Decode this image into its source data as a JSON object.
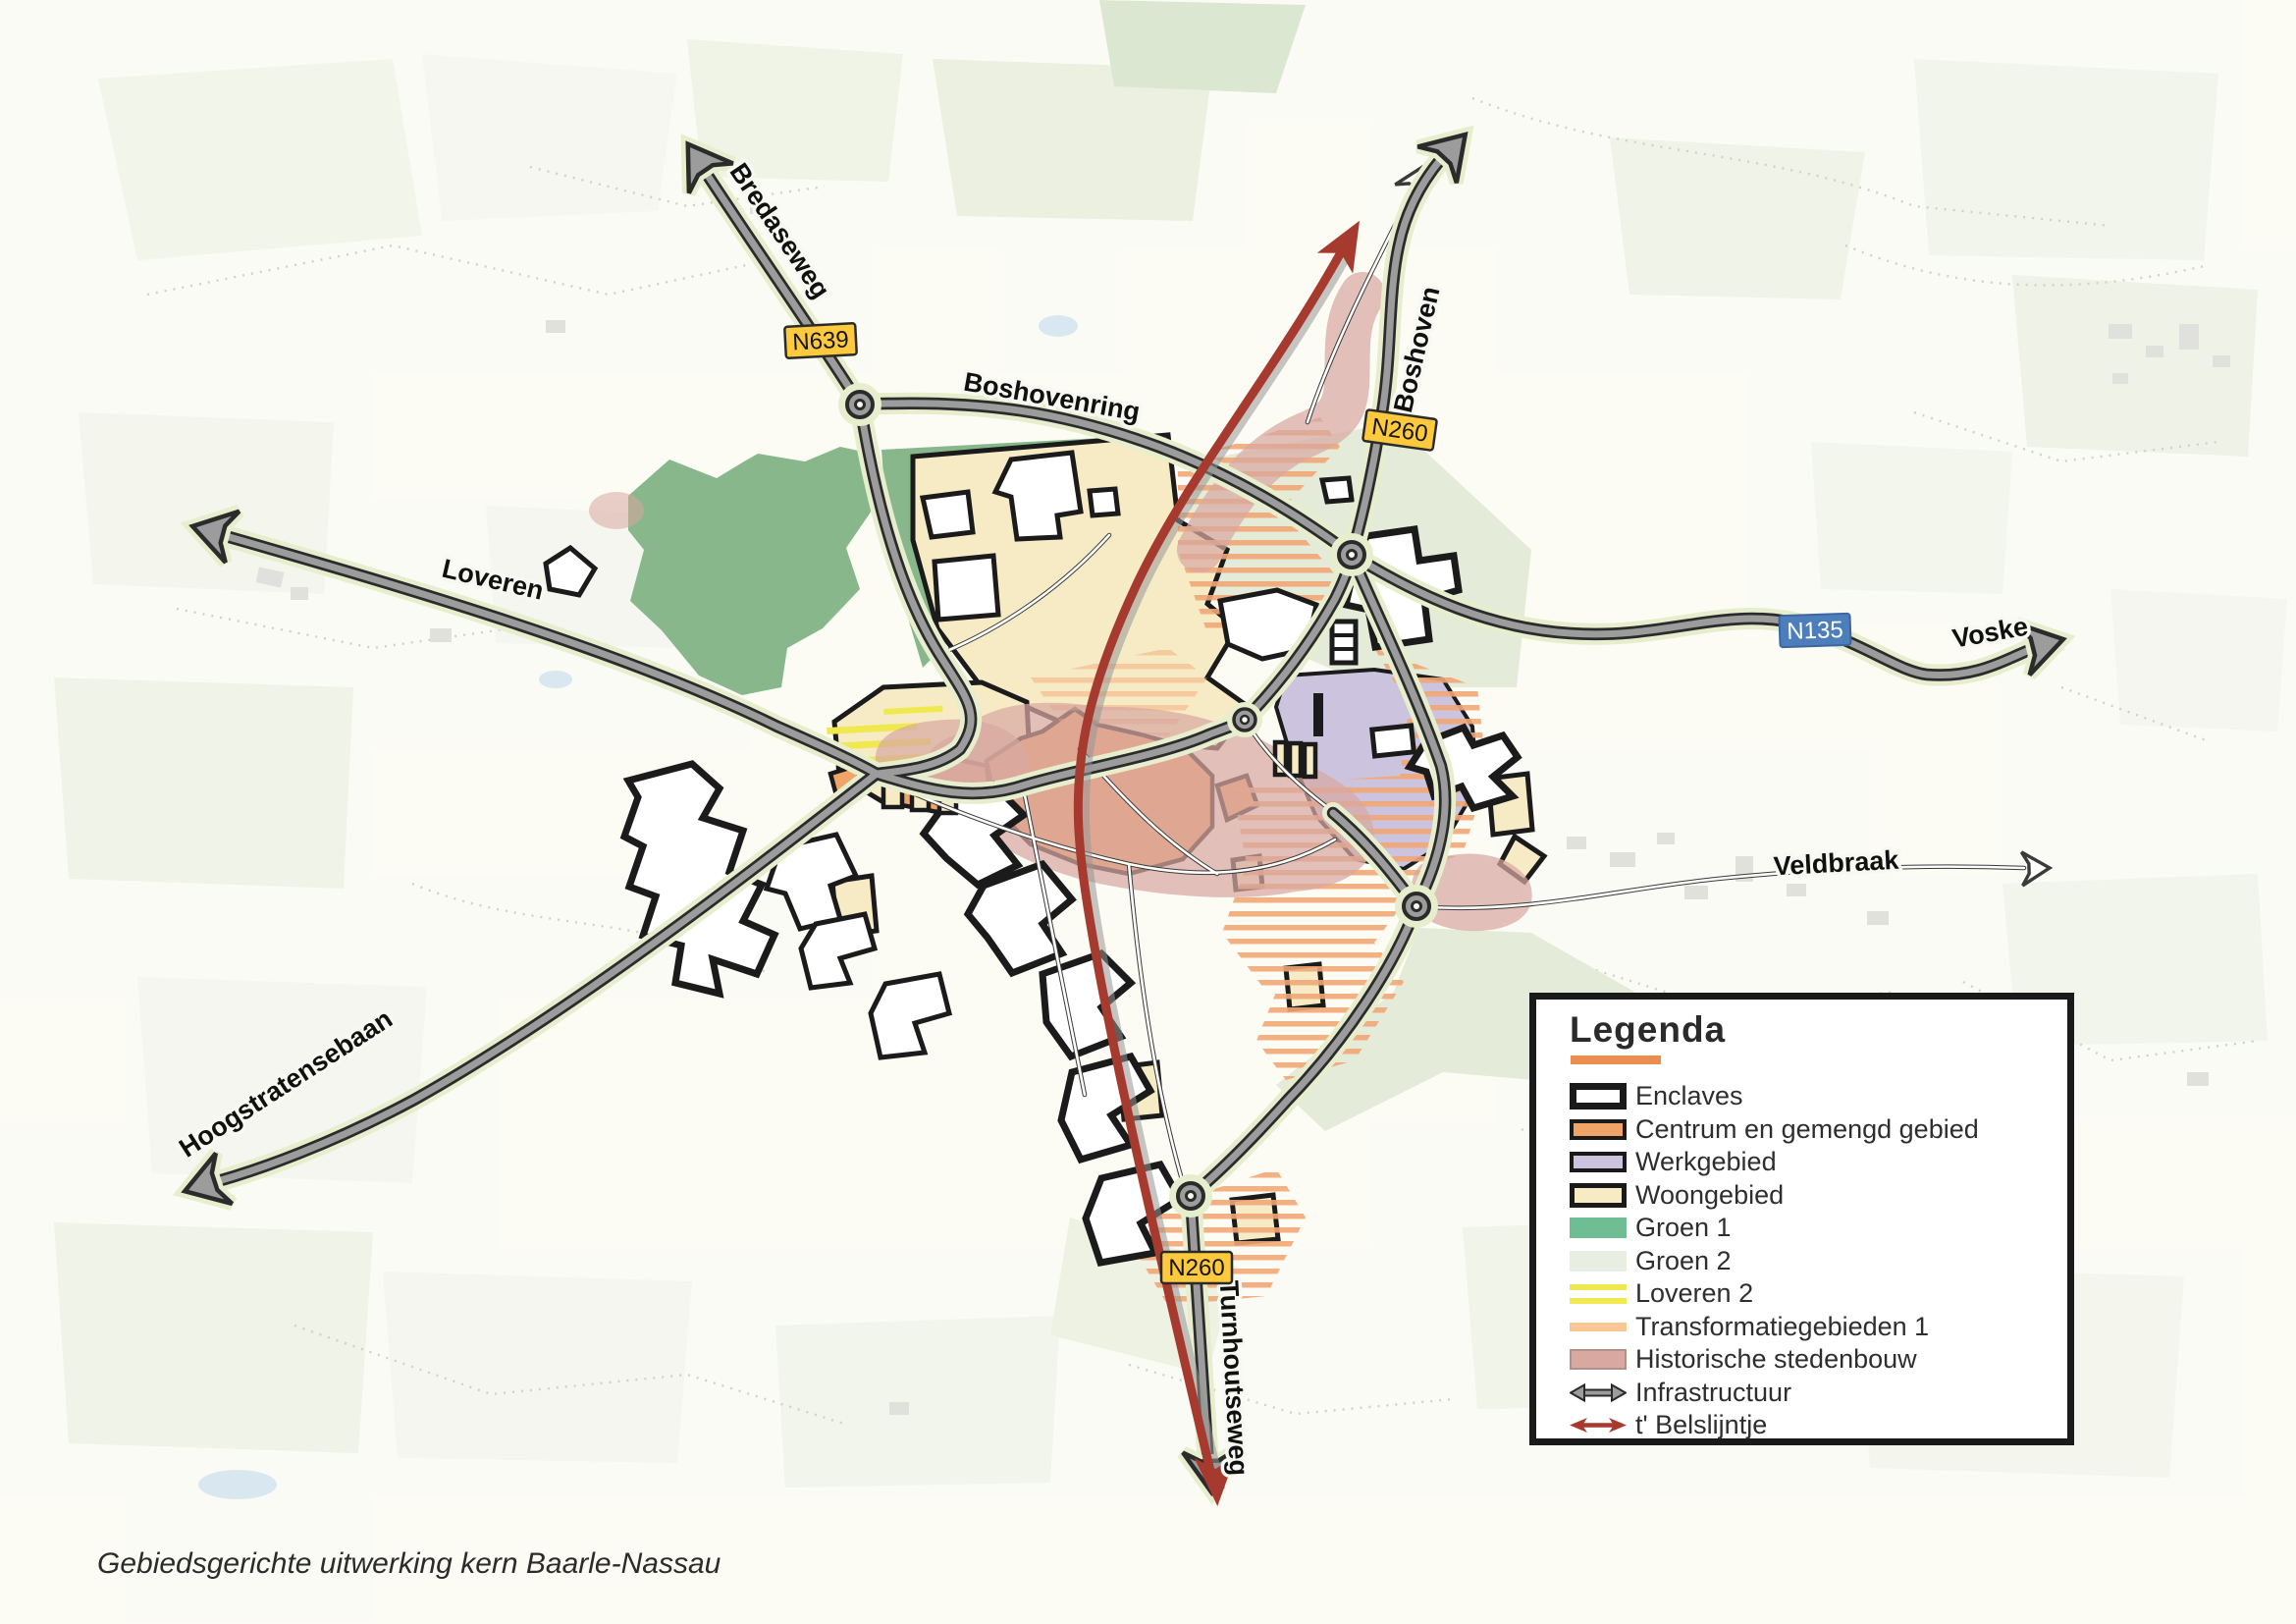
{
  "caption": "Gebiedsgerichte uitwerking kern Baarle-Nassau",
  "map": {
    "road_labels": {
      "bredaseweg": "Bredaseweg",
      "boshovenring": "Boshovenring",
      "boshoven": "Boshoven",
      "loveren": "Loveren",
      "voske": "Voske",
      "veldbraak": "Veldbraak",
      "hoogstratensebaan": "Hoogstratensebaan",
      "turnhoutseweg": "Turnhoutseweg"
    },
    "badges": {
      "n639": "N639",
      "n260_north": "N260",
      "n260_south": "N260",
      "n135": "N135"
    }
  },
  "legend": {
    "title": "Legenda",
    "items": [
      {
        "label": "Enclaves"
      },
      {
        "label": "Centrum en gemengd gebied"
      },
      {
        "label": "Werkgebied"
      },
      {
        "label": "Woongebied"
      },
      {
        "label": "Groen 1"
      },
      {
        "label": "Groen 2"
      },
      {
        "label": "Loveren 2"
      },
      {
        "label": "Transformatiegebieden 1"
      },
      {
        "label": "Historische stedenbouw"
      },
      {
        "label": "Infrastructuur"
      },
      {
        "label": "t' Belslijntje"
      }
    ]
  },
  "colors": {
    "centrum": "#F0A468",
    "werkgebied": "#CCC4DE",
    "woongebied": "#F6EBC5",
    "groen1": "#6FBE93",
    "groen1_map": "#89B78C",
    "groen2": "#E9EEE2",
    "groen2_map": "#E4EBD8",
    "loveren2": "#EFE84F",
    "transformatie": "#F9C793",
    "transformatie_map": "#F1A877",
    "historisch": "#D8A8A1",
    "infrastructuur": "#9C9C9C",
    "belslijntje": "#A63A2E",
    "badge_yellow": "#FFC93E",
    "badge_blue": "#4D7EBC",
    "legend_underline": "#EC8C4E"
  }
}
